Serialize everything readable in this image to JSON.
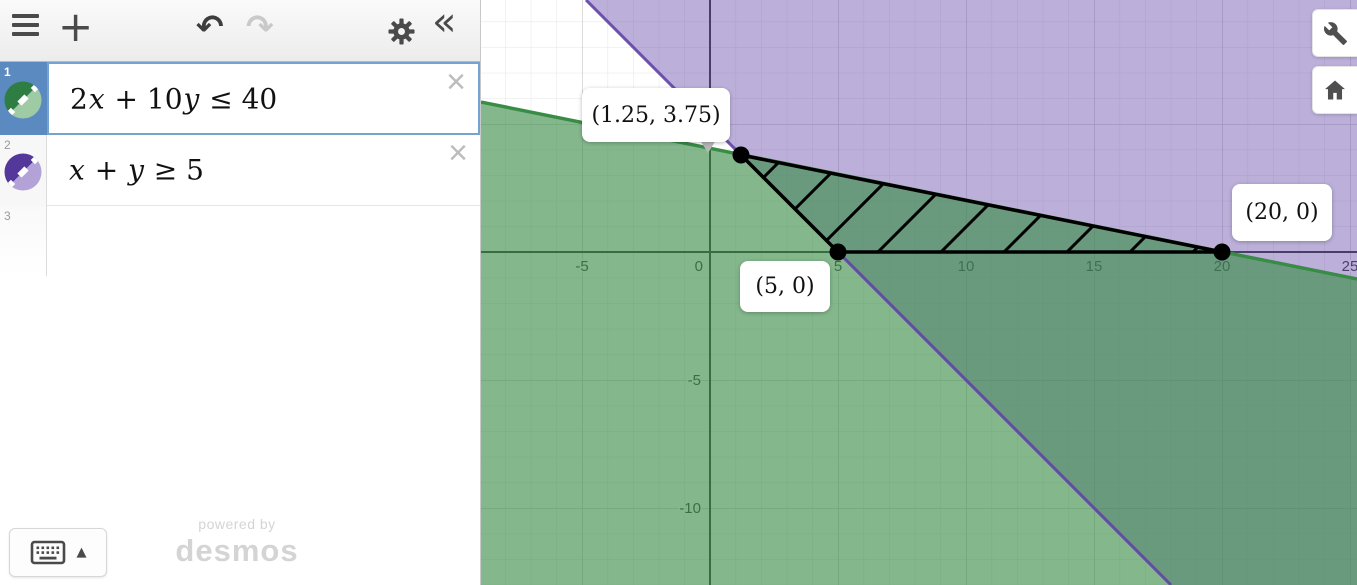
{
  "app": {
    "name": "Desmos Graphing Calculator"
  },
  "icons": {
    "add": "+",
    "undo": "↶",
    "redo": "↷",
    "collapse": "«",
    "close": "×",
    "keyboard_arrow": "▲"
  },
  "expressions": {
    "rows": [
      {
        "index": "1",
        "latex": "2x + 10y ≤ 40",
        "color_dark": "#2e7d43",
        "color_light": "#9fcba4",
        "selected": true
      },
      {
        "index": "2",
        "latex": "x + y ≥ 5",
        "color_dark": "#53379b",
        "color_light": "#b2a2d8",
        "selected": false
      },
      {
        "index": "3",
        "latex": "",
        "selected": false
      }
    ]
  },
  "watermark": {
    "line1": "powered by",
    "line2": "desmos"
  },
  "graph": {
    "point_labels": [
      {
        "text": "(1.25, 3.75)"
      },
      {
        "text": "(5, 0)"
      },
      {
        "text": "(20, 0)"
      }
    ],
    "x_ticks": [
      {
        "v": -5,
        "label": "-5"
      },
      {
        "v": 0,
        "label": "0"
      },
      {
        "v": 5,
        "label": "5"
      },
      {
        "v": 10,
        "label": "10"
      },
      {
        "v": 15,
        "label": "15"
      },
      {
        "v": 20,
        "label": "20"
      },
      {
        "v": 25,
        "label": "25"
      }
    ],
    "y_ticks": [
      {
        "v": -5,
        "label": "-5"
      },
      {
        "v": -10,
        "label": "-10"
      }
    ]
  },
  "chart_data": {
    "type": "inequality-region-plot",
    "expressions": [
      {
        "formula": "2x + 10y ≤ 40",
        "boundary": "2x + 10y = 40",
        "color": "#388c46",
        "fill_opacity": 0.62,
        "shaded_side": "below-line",
        "boundary_points": [
          [
            0,
            4
          ],
          [
            20,
            0
          ]
        ]
      },
      {
        "formula": "x + y ≥ 5",
        "boundary": "x + y = 5",
        "color": "#6042a6",
        "fill_opacity": 0.42,
        "shaded_side": "above-line",
        "boundary_points": [
          [
            0,
            5
          ],
          [
            5,
            0
          ]
        ]
      }
    ],
    "feasible_region_vertices": [
      [
        1.25,
        3.75
      ],
      [
        5,
        0
      ],
      [
        20,
        0
      ]
    ],
    "labeled_points": [
      {
        "x": 1.25,
        "y": 3.75,
        "label": "(1.25, 3.75)"
      },
      {
        "x": 5,
        "y": 0,
        "label": "(5, 0)"
      },
      {
        "x": 20,
        "y": 0,
        "label": "(20, 0)"
      }
    ],
    "hatched_region": "triangle with vertices (1.25,3.75), (5,0), (20,0), black diagonal hatching",
    "x_ticks": [
      -5,
      0,
      5,
      10,
      15,
      20,
      25
    ],
    "y_ticks": [
      -5,
      -10
    ],
    "x_range": [
      -8.95,
      25.27
    ],
    "y_range": [
      -13.0,
      9.84
    ],
    "grid": true,
    "minor_grid": true,
    "overlap_fill_color": "#6f9a8a",
    "green_fill_color": "#80b38d",
    "purple_fill_color": "#bcaede"
  }
}
